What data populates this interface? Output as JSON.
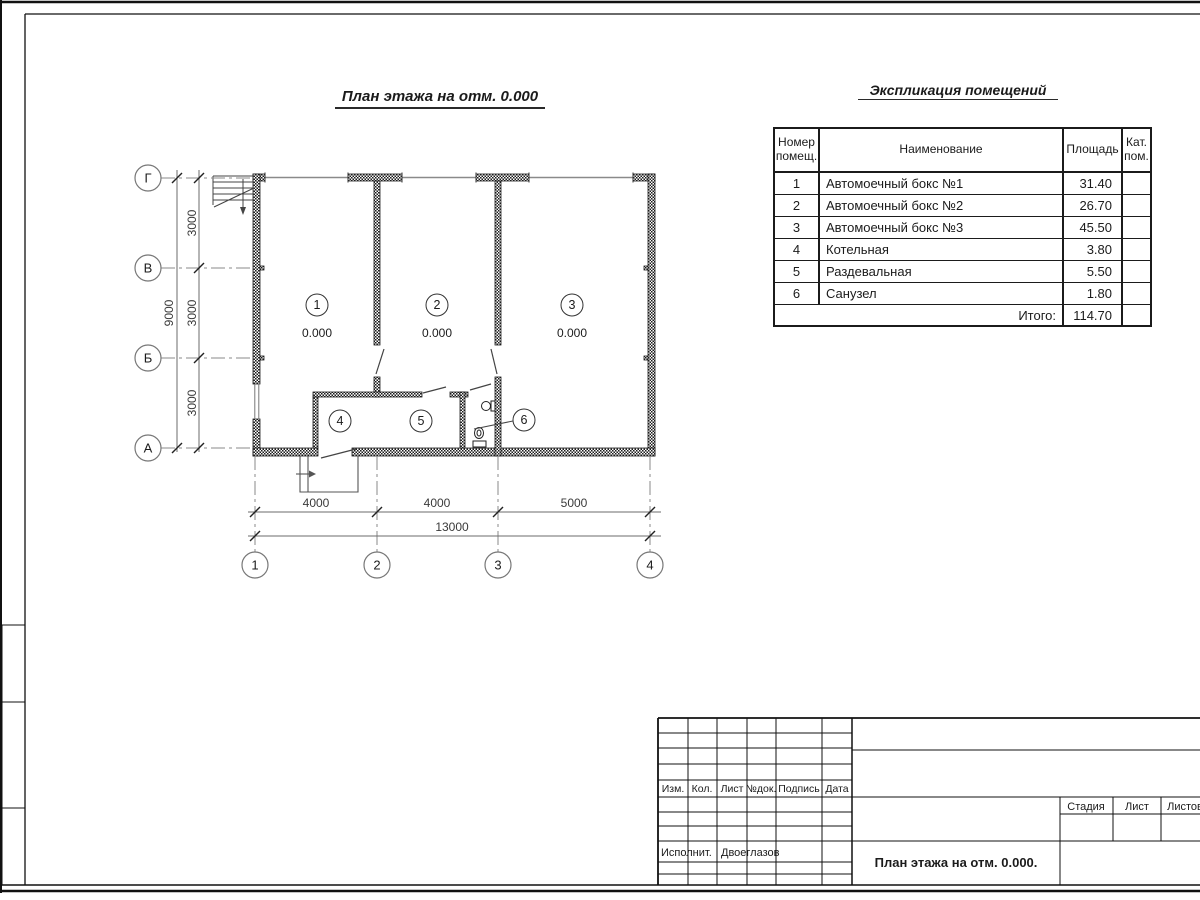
{
  "sheet": {
    "plan_title": "План этажа на отм. 0.000",
    "schedule_title": "Экспликация помещений"
  },
  "plan": {
    "axis_letters": [
      "Г",
      "В",
      "Б",
      "А"
    ],
    "axis_numbers": [
      "1",
      "2",
      "3",
      "4"
    ],
    "vertical_dims": [
      "3000",
      "3000",
      "3000"
    ],
    "vertical_total_dim": "9000",
    "horizontal_dims": [
      "4000",
      "4000",
      "5000"
    ],
    "horizontal_total_dim": "13000",
    "room_numbers": [
      "1",
      "2",
      "3",
      "4",
      "5",
      "6"
    ],
    "elevation_marks": [
      "0.000",
      "0.000",
      "0.000"
    ]
  },
  "schedule": {
    "headers": {
      "number": "Номер помещ.",
      "name": "Наименование",
      "area": "Площадь",
      "category": "Кат. пом."
    },
    "rows": [
      {
        "number": "1",
        "name": "Автомоечный бокс №1",
        "area": "31.40",
        "category": ""
      },
      {
        "number": "2",
        "name": "Автомоечный бокс №2",
        "area": "26.70",
        "category": ""
      },
      {
        "number": "3",
        "name": "Автомоечный бокс №3",
        "area": "45.50",
        "category": ""
      },
      {
        "number": "4",
        "name": "Котельная",
        "area": "3.80",
        "category": ""
      },
      {
        "number": "5",
        "name": "Раздевальная",
        "area": "5.50",
        "category": ""
      },
      {
        "number": "6",
        "name": "Санузел",
        "area": "1.80",
        "category": ""
      }
    ],
    "total_label": "Итого:",
    "total_area": "114.70"
  },
  "title_block": {
    "columns": [
      "Изм.",
      "Кол.",
      "Лист",
      "№док.",
      "Подпись",
      "Дата"
    ],
    "executor_label": "Исполнит.",
    "executor_name": "Двоеглазов",
    "stage_label": "Стадия",
    "sheet_label": "Лист",
    "sheets_label": "Листов",
    "document_title": "План этажа на отм. 0.000."
  }
}
